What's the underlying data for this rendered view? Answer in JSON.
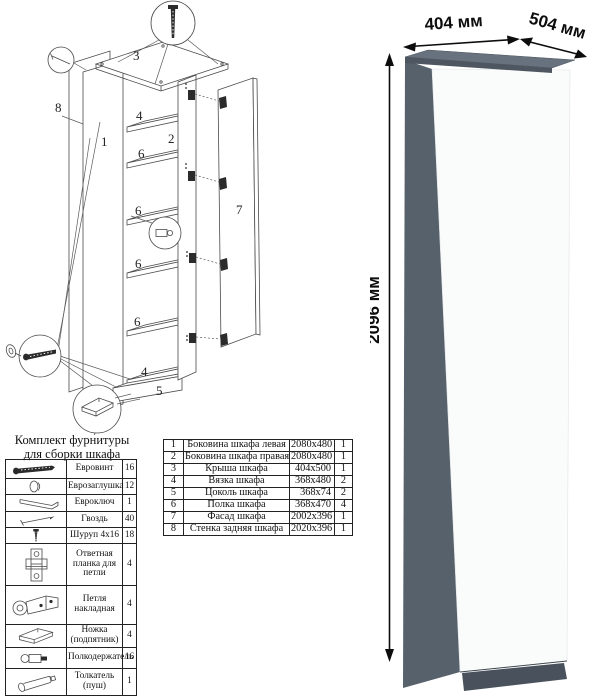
{
  "diagram": {
    "labels": [
      {
        "t": "3",
        "x": 133,
        "y": 60
      },
      {
        "t": "8",
        "x": 55,
        "y": 112
      },
      {
        "t": "1",
        "x": 101,
        "y": 146
      },
      {
        "t": "4",
        "x": 136,
        "y": 120
      },
      {
        "t": "2",
        "x": 168,
        "y": 143
      },
      {
        "t": "6",
        "x": 138,
        "y": 158
      },
      {
        "t": "6",
        "x": 135,
        "y": 215
      },
      {
        "t": "6",
        "x": 135,
        "y": 268
      },
      {
        "t": "6",
        "x": 134,
        "y": 326
      },
      {
        "t": "4",
        "x": 141,
        "y": 376
      },
      {
        "t": "5",
        "x": 156,
        "y": 395
      },
      {
        "t": "7",
        "x": 236,
        "y": 214
      }
    ]
  },
  "hardware": {
    "title_line1": "Комплект фурнитуры",
    "title_line2": "для сборки шкафа",
    "rows": [
      {
        "icon": "euro-screw",
        "name": "Евровинт",
        "qty": "16"
      },
      {
        "icon": "euro-cap",
        "name": "Еврозаглушка",
        "qty": "12"
      },
      {
        "icon": "euro-key",
        "name": "Евроключ",
        "qty": "1"
      },
      {
        "icon": "nail",
        "name": "Гвоздь",
        "qty": "40"
      },
      {
        "icon": "screw-4x16",
        "name": "Шуруп 4x16",
        "qty": "18"
      },
      {
        "icon": "hinge-plate",
        "name": "Ответная планка для петли",
        "qty": "4"
      },
      {
        "icon": "hinge",
        "name": "Петля накладная",
        "qty": "4"
      },
      {
        "icon": "foot",
        "name": "Ножка (подпятник)",
        "qty": "4"
      },
      {
        "icon": "shelf-support",
        "name": "Полкодержатель",
        "qty": "16"
      },
      {
        "icon": "push-rod",
        "name": "Толкатель (пуш)",
        "qty": "1"
      }
    ]
  },
  "parts": {
    "rows": [
      {
        "num": "1",
        "name": "Боковина шкафа левая",
        "size": "2080x480",
        "qty": "1"
      },
      {
        "num": "2",
        "name": "Боковина шкафа правая",
        "size": "2080x480",
        "qty": "1"
      },
      {
        "num": "3",
        "name": "Крыша шкафа",
        "size": "404x500",
        "qty": "1"
      },
      {
        "num": "4",
        "name": "Вязка шкафа",
        "size": "368x480",
        "qty": "2"
      },
      {
        "num": "5",
        "name": "Цоколь шкафа",
        "size": "368x74",
        "qty": "2"
      },
      {
        "num": "6",
        "name": "Полка шкафа",
        "size": "368x470",
        "qty": "4"
      },
      {
        "num": "7",
        "name": "Фасад шкафа",
        "size": "2002x396",
        "qty": "1"
      },
      {
        "num": "8",
        "name": "Стенка задняя шкафа",
        "size": "2020x396",
        "qty": "1"
      }
    ]
  },
  "render": {
    "width_label": "404 мм",
    "depth_label": "504 мм",
    "height_label": "2096 мм",
    "colors": {
      "top": "#68727e",
      "top_edge": "#4e5761",
      "side": "#57616b",
      "front": "#fafbfb",
      "plinth": "#49525c"
    }
  }
}
